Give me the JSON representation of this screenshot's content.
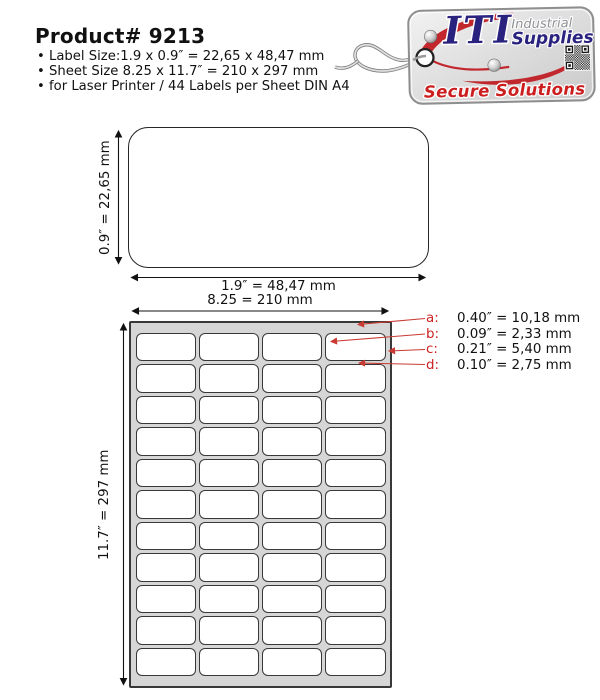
{
  "header": {
    "title": "Product# 9213",
    "bullet_char": "•",
    "bullets": [
      "Label Size:1.9 x 0.9″ = 22,65 x 48,47 mm",
      "Sheet Size 8.25 x 11.7″ = 210 x 297 mm",
      "for Laser Printer / 44 Labels per Sheet DIN A4"
    ]
  },
  "logo_tag": {
    "brand_main": "ITI",
    "brand_top": "Industrial",
    "brand_bottom": "Supplies",
    "tagline": "Secure Solutions",
    "colors": {
      "navy": "#29227f",
      "red": "#c1272d",
      "gray_text": "#8f9095",
      "tag_fill": "#d9d9d9"
    }
  },
  "single_label": {
    "height_dim": "0.9″ = 22,65 mm",
    "width_dim": "1.9″ = 48,47 mm"
  },
  "sheet": {
    "width_dim": "8.25 = 210 mm",
    "height_dim": "11.7″ = 297 mm",
    "columns": 4,
    "rows": 11,
    "labels_total": 44,
    "annotations": [
      {
        "key": "a:",
        "value": "0.40″ = 10,18 mm"
      },
      {
        "key": "b:",
        "value": "0.09″ = 2,33 mm"
      },
      {
        "key": "c:",
        "value": "0.21″ = 5,40 mm"
      },
      {
        "key": "d:",
        "value": "0.10″ = 2,75 mm"
      }
    ],
    "colors": {
      "sheet_fill": "#d6d6d6",
      "label_fill": "#ffffff",
      "line": "#383838",
      "annotation_red": "#cc2222"
    }
  }
}
